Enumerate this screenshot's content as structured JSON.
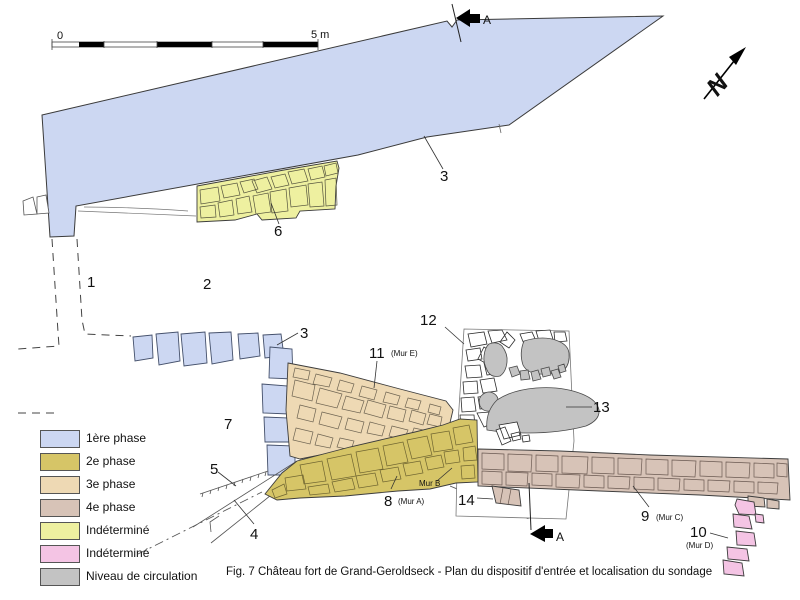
{
  "figure": {
    "caption": "Fig. 7 Château fort de Grand-Geroldseck - Plan du dispositif d'entrée et localisation du sondage"
  },
  "scale_bar": {
    "zero": "0",
    "five_m": "5 m"
  },
  "north": {
    "letter": "N"
  },
  "section": {
    "top": "A",
    "bottom": "A"
  },
  "colors": {
    "phase1": "#ccd7f2",
    "phase2": "#d6c567",
    "phase3": "#eed9b4",
    "phase4": "#d7c3b7",
    "indet_yellow": "#eef0a0",
    "indet_pink": "#f4c4e4",
    "circulation": "#c3c3c3",
    "outline": "#333333"
  },
  "legend": {
    "items": [
      {
        "label": "1ère phase",
        "color": "#ccd7f2"
      },
      {
        "label": "2e phase",
        "color": "#d6c567"
      },
      {
        "label": "3e phase",
        "color": "#eed9b4"
      },
      {
        "label": "4e phase",
        "color": "#d7c3b7"
      },
      {
        "label": "Indéterminé",
        "color": "#eef0a0"
      },
      {
        "label": "Indéterminé",
        "color": "#f4c4e4"
      },
      {
        "label": "Niveau de circulation",
        "color": "#c3c3c3"
      }
    ]
  },
  "plan_labels": {
    "n1": "1",
    "n2": "2",
    "n3_upper": "3",
    "n3_lower": "3",
    "n4": "4",
    "n5": "5",
    "n6": "6",
    "n7": "7",
    "n8": "8",
    "n8_sub": "(Mur A)",
    "mur_b": "Mur B",
    "n9": "9",
    "n9_sub": "(Mur C)",
    "n10": "10",
    "n10_sub": "(Mur D)",
    "n11": "11",
    "n11_sub": "(Mur E)",
    "n12": "12",
    "n13": "13",
    "n14": "14"
  }
}
